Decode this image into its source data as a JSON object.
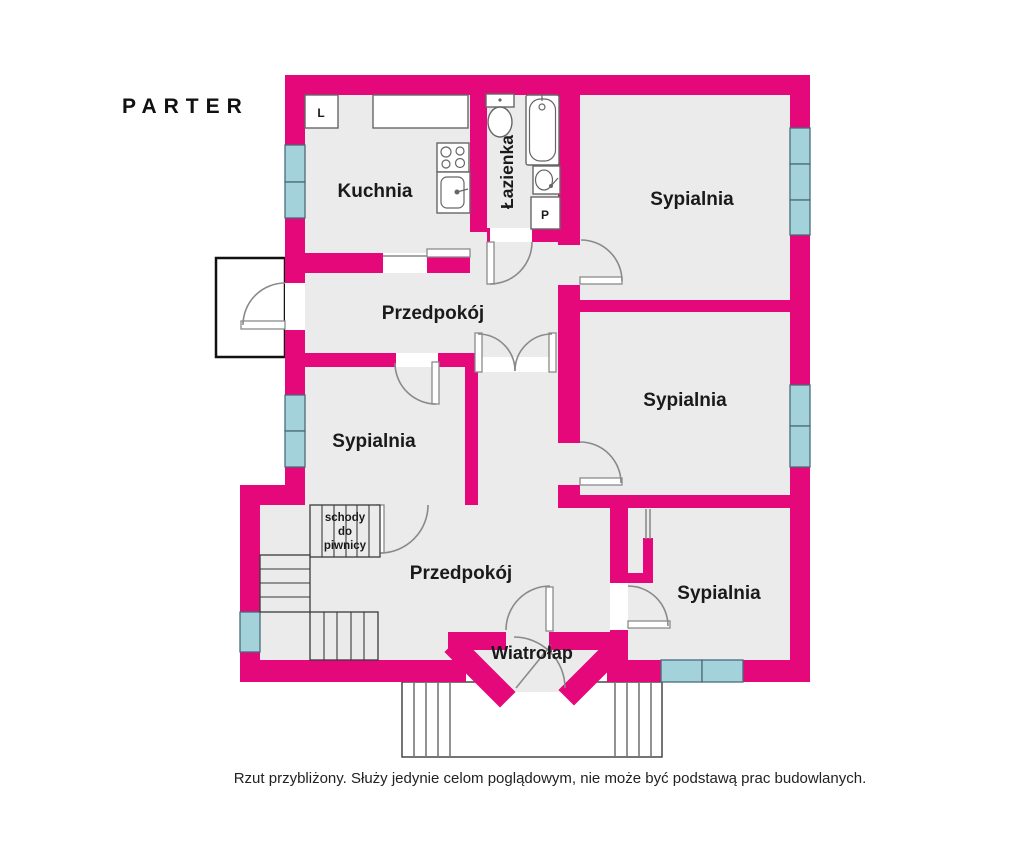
{
  "title": "PARTER",
  "disclaimer": "Rzut przybliżony. Służy jedynie celom poglądowym, nie może być podstawą prac budowlanych.",
  "rooms": {
    "kitchen": "Kuchnia",
    "bathroom": "Łazienka",
    "bedroom_top_right": "Sypialnia",
    "bedroom_middle_right": "Sypialnia",
    "bedroom_left": "Sypialnia",
    "bedroom_bottom_right": "Sypialnia",
    "hallway_upper": "Przedpokój",
    "hallway_lower": "Przedpokój",
    "vestibule": "Wiatrołap"
  },
  "fixtures": {
    "fridge_label": "L",
    "washer_label": "P"
  },
  "stairs": {
    "basement_label_lines": [
      "schody",
      "do",
      "piwnicy"
    ]
  },
  "colors": {
    "wall": "#E4087B",
    "window": "#A3D2DB",
    "window_border": "#4A6B78",
    "floor": "#EBEBEB",
    "door": "#8A8A8A",
    "porch_border": "#111111",
    "stair": "#3A3A3A",
    "fixture": "#666666",
    "text": "#1A1A1A"
  }
}
